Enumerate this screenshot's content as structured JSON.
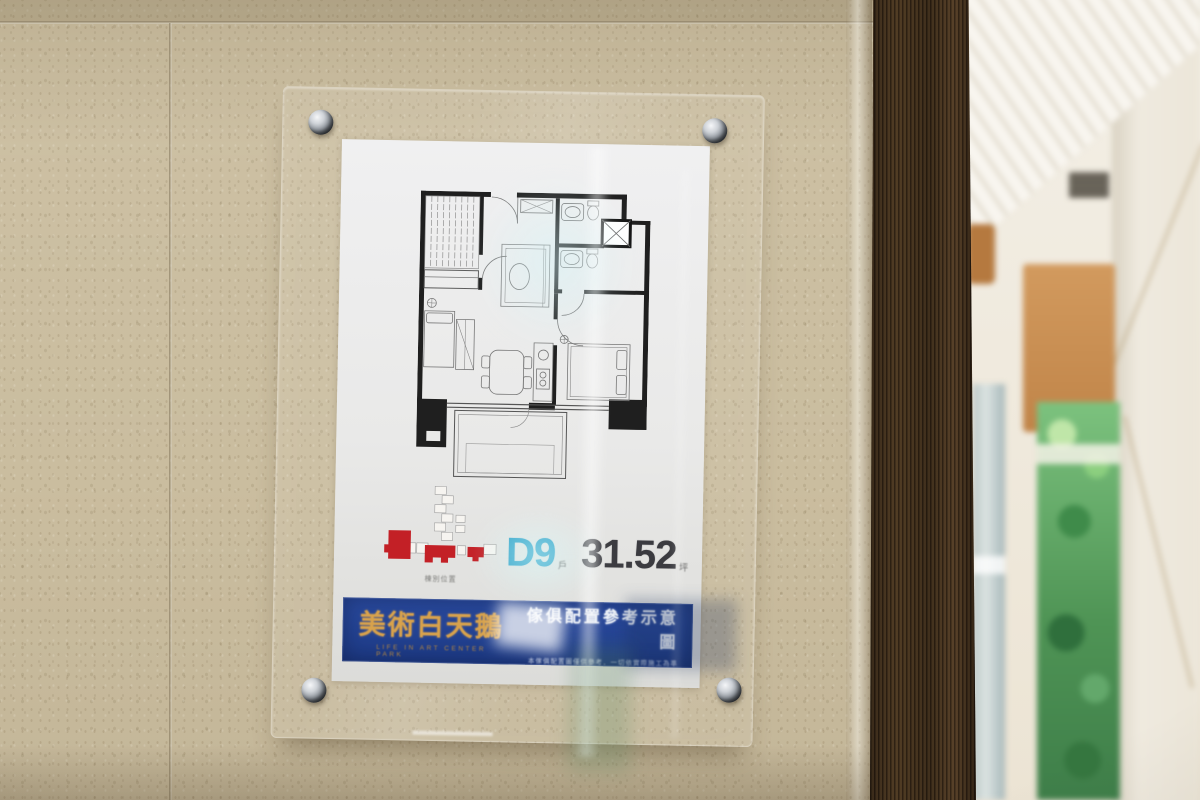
{
  "sign": {
    "unit": {
      "code": "D9",
      "code_unit": "戶",
      "area": "31.52",
      "area_unit": "坪"
    },
    "key_plan_caption": "棟別位置",
    "banner": {
      "brand": "美術白天鵝",
      "brand_subtitle": "LIFE IN ART CENTER PARK",
      "title": "傢俱配置參考示意圖",
      "disclaimer": "本傢俱配置圖僅供參考．一切依實際施工為準"
    },
    "colors": {
      "banner_blue": "#24459a",
      "brand_gold": "#d8a24c",
      "unit_code_blue": "#2fa3c9",
      "area_text": "#3b3b40",
      "keyplan_red": "#c32026"
    }
  }
}
